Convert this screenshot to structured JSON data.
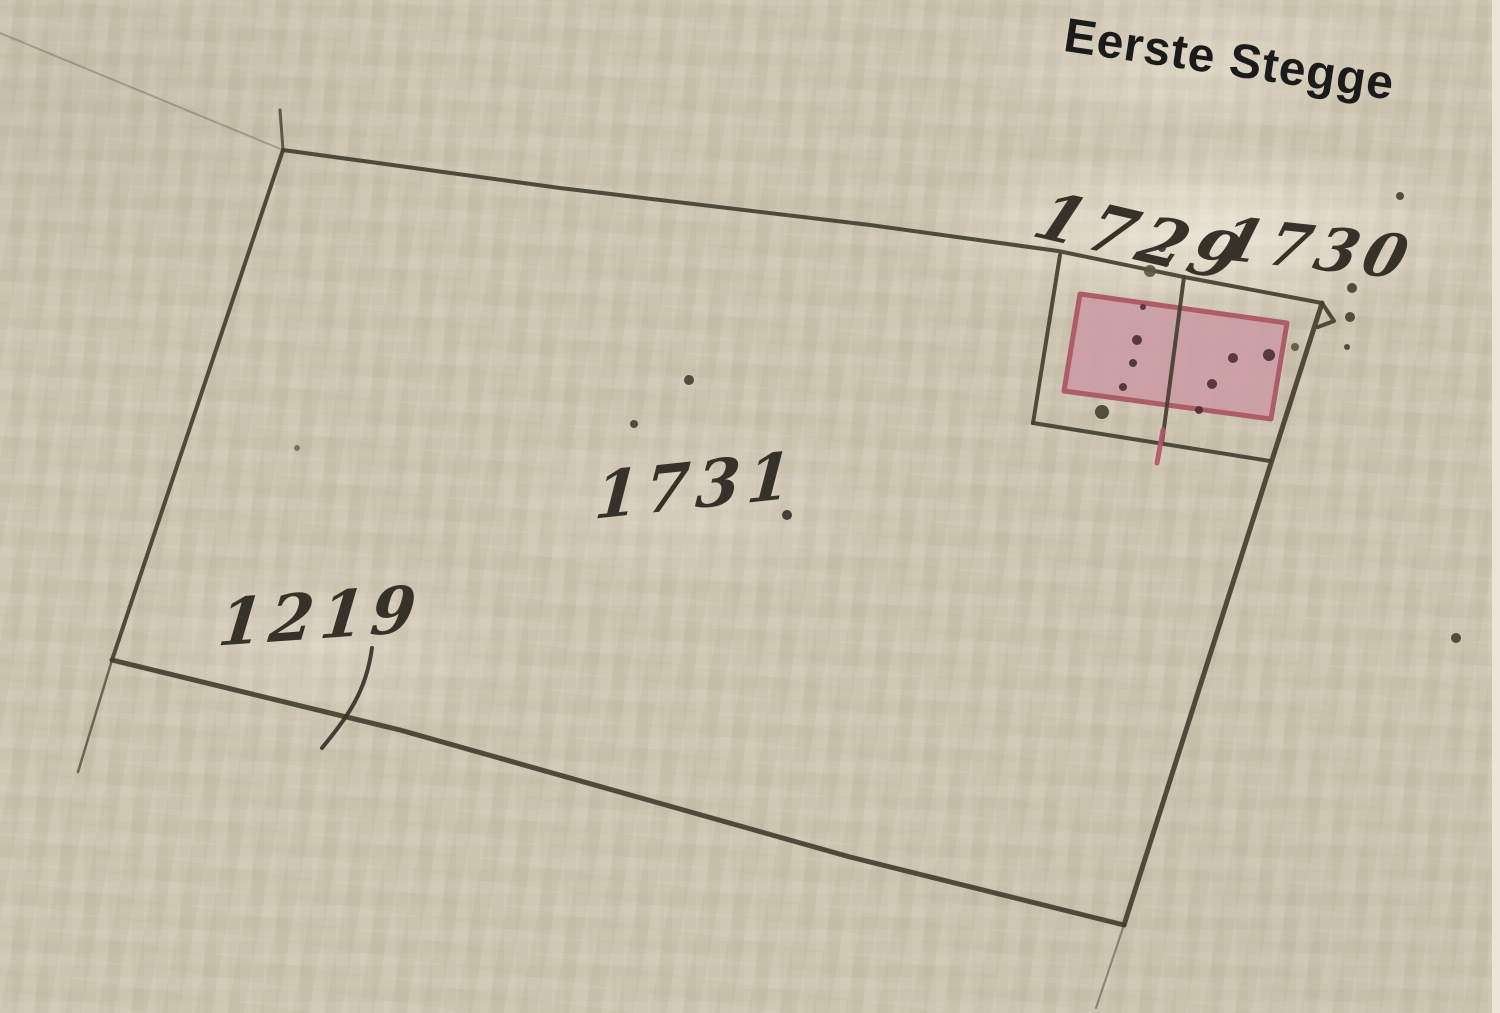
{
  "page": {
    "kind": "historical-cadastral-sketch-map",
    "width": 1500,
    "height": 1013
  },
  "colors": {
    "paper": "#cfc6b1",
    "paper_light": "#eae4d6",
    "ink": "#443f30",
    "handwriting": "#36322a",
    "modern_text": "#1b1b1b",
    "maroon": "#4a2f33",
    "olive": "#56573e",
    "red_line": "#b4566a",
    "building_fill": "#cb9aa2",
    "building_stroke": "#ad5c69"
  },
  "labels": [
    {
      "name": "street-label",
      "text": "Eerste Stegge",
      "kind": "modern",
      "x": 1068,
      "y": 12,
      "rotation": 8.5,
      "font_size": 48
    },
    {
      "name": "parcel-label-1729",
      "text": "1729",
      "kind": "handwritten",
      "x": 1052,
      "y": 183,
      "rotation": 13,
      "font_size": 66
    },
    {
      "name": "parcel-label-1730",
      "text": "1730",
      "kind": "handwritten",
      "x": 1230,
      "y": 210,
      "rotation": 6,
      "font_size": 60
    },
    {
      "name": "parcel-label-1731",
      "text": "1731",
      "kind": "handwritten",
      "x": 597,
      "y": 465,
      "rotation": -6,
      "font_size": 64
    },
    {
      "name": "parcel-label-1219",
      "text": "1219",
      "kind": "handwritten",
      "x": 222,
      "y": 592,
      "rotation": -4,
      "font_size": 64
    }
  ],
  "map": {
    "building": {
      "name": "building-parcels-1729-1730",
      "points": [
        [
          1080,
          294
        ],
        [
          1287,
          323
        ],
        [
          1271,
          419
        ],
        [
          1064,
          391
        ]
      ],
      "fill": "building_fill",
      "stroke": "building_stroke",
      "stroke_width": 5
    },
    "strokes": [
      {
        "name": "parcel-1731-boundary-top",
        "points": [
          [
            283,
            150
          ],
          [
            560,
            188
          ],
          [
            870,
            225
          ],
          [
            1058,
            251
          ],
          [
            1184,
            277
          ],
          [
            1322,
            303
          ]
        ],
        "width": 4
      },
      {
        "name": "parcel-1731-boundary-right",
        "points": [
          [
            1322,
            303
          ],
          [
            1124,
            925
          ]
        ],
        "width": 5
      },
      {
        "name": "parcel-1731-boundary-bottom",
        "points": [
          [
            1124,
            925
          ],
          [
            850,
            857
          ],
          [
            400,
            730
          ],
          [
            112,
            660
          ]
        ],
        "width": 5
      },
      {
        "name": "parcel-1731-boundary-left",
        "points": [
          [
            112,
            660
          ],
          [
            283,
            150
          ]
        ],
        "width": 4
      },
      {
        "name": "corner-hook-top-right",
        "points": [
          [
            1322,
            303
          ],
          [
            1334,
            321
          ],
          [
            1318,
            327
          ]
        ],
        "width": 4
      },
      {
        "name": "left-boundary-upper-tick",
        "points": [
          [
            283,
            150
          ],
          [
            280,
            110
          ]
        ],
        "width": 3,
        "opacity": 0.8
      },
      {
        "name": "left-boundary-extension",
        "points": [
          [
            112,
            660
          ],
          [
            78,
            772
          ]
        ],
        "width": 2.5,
        "opacity": 0.7
      },
      {
        "name": "right-boundary-extension",
        "points": [
          [
            1124,
            925
          ],
          [
            1096,
            1008
          ]
        ],
        "width": 2,
        "opacity": 0.5
      },
      {
        "name": "faint-line-top-left",
        "points": [
          [
            0,
            33
          ],
          [
            283,
            150
          ]
        ],
        "width": 2,
        "opacity": 0.3
      },
      {
        "name": "subparcel-left-edge",
        "points": [
          [
            1060,
            255
          ],
          [
            1033,
            423
          ]
        ],
        "width": 4
      },
      {
        "name": "subparcel-bottom-edge",
        "points": [
          [
            1033,
            423
          ],
          [
            1270,
            461
          ]
        ],
        "width": 4
      },
      {
        "name": "subparcel-divider-1729-1730",
        "points": [
          [
            1184,
            277
          ],
          [
            1162,
            443
          ]
        ],
        "width": 4
      },
      {
        "name": "divider-red-tail",
        "points": [
          [
            1163,
            430
          ],
          [
            1157,
            463
          ]
        ],
        "width": 5,
        "color": "red_line"
      },
      {
        "name": "digit-9-tail-of-1219",
        "path": "M 372 648 C 366 692 348 716 322 748",
        "width": 4,
        "color": "handwriting"
      }
    ],
    "dots": [
      {
        "name": "building-dot-1",
        "x": 1143,
        "y": 307,
        "r": 3,
        "color": "maroon"
      },
      {
        "name": "building-dot-2",
        "x": 1137,
        "y": 340,
        "r": 5,
        "color": "maroon"
      },
      {
        "name": "building-dot-3",
        "x": 1133,
        "y": 363,
        "r": 4,
        "color": "maroon"
      },
      {
        "name": "building-dot-4",
        "x": 1123,
        "y": 387,
        "r": 4,
        "color": "maroon"
      },
      {
        "name": "dot-below-building",
        "x": 1102,
        "y": 412,
        "r": 7,
        "color": "ink"
      },
      {
        "name": "building-dot-5",
        "x": 1233,
        "y": 358,
        "r": 5,
        "color": "maroon"
      },
      {
        "name": "building-dot-6",
        "x": 1269,
        "y": 355,
        "r": 6,
        "color": "maroon"
      },
      {
        "name": "building-dot-7",
        "x": 1212,
        "y": 384,
        "r": 5,
        "color": "maroon"
      },
      {
        "name": "building-dot-8",
        "x": 1199,
        "y": 410,
        "r": 4,
        "color": "maroon"
      },
      {
        "name": "dot-right-of-building",
        "x": 1295,
        "y": 347,
        "r": 4,
        "color": "olive"
      },
      {
        "name": "corner-dot-a",
        "x": 1352,
        "y": 288,
        "r": 5,
        "color": "ink"
      },
      {
        "name": "corner-dot-b",
        "x": 1350,
        "y": 317,
        "r": 5,
        "color": "ink"
      },
      {
        "name": "corner-dot-c",
        "x": 1347,
        "y": 347,
        "r": 3,
        "color": "ink"
      },
      {
        "name": "dot-top-right",
        "x": 1400,
        "y": 196,
        "r": 4,
        "color": "ink"
      },
      {
        "name": "dot-field-right",
        "x": 1456,
        "y": 638,
        "r": 5,
        "color": "ink"
      },
      {
        "name": "field-dot-1",
        "x": 689,
        "y": 380,
        "r": 5,
        "color": "ink"
      },
      {
        "name": "field-dot-2",
        "x": 634,
        "y": 424,
        "r": 4,
        "color": "ink"
      },
      {
        "name": "field-speck",
        "x": 297,
        "y": 448,
        "r": 3,
        "color": "ink",
        "opacity": 0.6
      },
      {
        "name": "period-after-1731",
        "x": 787,
        "y": 515,
        "r": 5,
        "color": "handwriting"
      },
      {
        "name": "colon-after-1729-a",
        "x": 1162,
        "y": 248,
        "r": 4,
        "color": "handwriting"
      },
      {
        "name": "colon-after-1729-b",
        "x": 1166,
        "y": 264,
        "r": 3,
        "color": "handwriting"
      },
      {
        "name": "junction-ink-blob",
        "x": 1150,
        "y": 271,
        "r": 6,
        "color": "olive"
      }
    ]
  }
}
